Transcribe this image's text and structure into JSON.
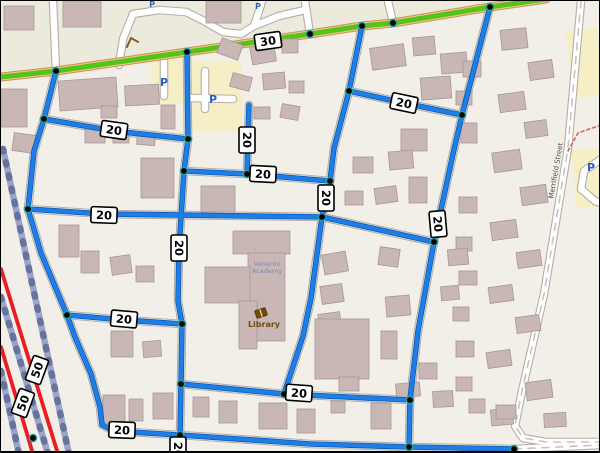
{
  "map": {
    "title": "speed-limit-map-view",
    "colors": {
      "background": "#f2efe9",
      "commercial_band": "#eceadc",
      "parking_fill": "#f6efc5",
      "building_fill": "#c9b7b6",
      "building_stroke": "#a99595",
      "road_white": "#ffffff",
      "road_casing": "#b3afa6",
      "route_20_blue_dark": "#0d5ab2",
      "route_20_blue": "#1f7de6",
      "road_30_green": "#55c418",
      "road_30_casing": "#c99254",
      "road_30_fill": "#f2c78e",
      "road_50_red": "#ea1c24",
      "railway": "#9aa5c8",
      "railway_ties": "#66739f",
      "node_fill": "#000000",
      "node_ring": "#1fa3a3",
      "badge_bg": "#ffffff",
      "badge_border": "#000000",
      "parking_letter": "#2e5fc4",
      "library_brown": "#744a0b",
      "academy_label": "#7a88ad",
      "street_label": "#4f4f4f"
    },
    "speed_limit_legend": {
      "blue_roads": "20",
      "green_road": "30",
      "red_roads": "50"
    },
    "landuse": {
      "commercial_band": [
        [
          0,
          0
        ],
        [
          545,
          0
        ],
        [
          489,
          6
        ],
        [
          361,
          25
        ],
        [
          186,
          51
        ],
        [
          55,
          70
        ],
        [
          0,
          76
        ]
      ],
      "parking_lots": [
        [
          150,
          56,
          38,
          46,
          0
        ],
        [
          187,
          60,
          54,
          70,
          0
        ],
        [
          573,
          148,
          30,
          58,
          -5
        ],
        [
          568,
          28,
          32,
          68,
          -6
        ]
      ]
    },
    "major_road_30": [
      [
        0,
        76
      ],
      [
        55,
        70
      ],
      [
        186,
        51
      ],
      [
        309,
        33
      ],
      [
        361,
        25
      ],
      [
        392,
        22
      ],
      [
        489,
        6
      ],
      [
        545,
        -2
      ]
    ],
    "railways": [
      [
        [
          2,
          148
        ],
        [
          68,
          453
        ]
      ],
      [
        [
          0,
          296
        ],
        [
          47,
          453
        ]
      ],
      [
        [
          0,
          370
        ],
        [
          18,
          453
        ]
      ]
    ],
    "trunk_roads_50": [
      [
        [
          0,
          268
        ],
        [
          57,
          453
        ]
      ],
      [
        [
          0,
          346
        ],
        [
          32,
          453
        ]
      ]
    ],
    "routes_20": [
      [
        [
          55,
          70
        ],
        [
          43,
          118
        ],
        [
          33,
          150
        ],
        [
          27,
          208
        ],
        [
          40,
          252
        ],
        [
          66,
          314
        ],
        [
          74,
          336
        ],
        [
          90,
          373
        ],
        [
          99,
          406
        ],
        [
          101,
          424
        ],
        [
          113,
          430
        ],
        [
          179,
          434
        ],
        [
          310,
          443
        ],
        [
          408,
          446
        ],
        [
          513,
          448
        ]
      ],
      [
        [
          43,
          118
        ],
        [
          113,
          130
        ],
        [
          187,
          138
        ]
      ],
      [
        [
          186,
          51
        ],
        [
          187,
          138
        ],
        [
          183,
          170
        ],
        [
          178,
          248
        ],
        [
          177,
          300
        ],
        [
          181,
          323
        ],
        [
          180,
          383
        ],
        [
          179,
          434
        ],
        [
          177,
          453
        ]
      ],
      [
        [
          27,
          208
        ],
        [
          103,
          213
        ],
        [
          321,
          216
        ]
      ],
      [
        [
          183,
          170
        ],
        [
          246,
          173
        ],
        [
          329,
          180
        ]
      ],
      [
        [
          248,
          104
        ],
        [
          246,
          173
        ]
      ],
      [
        [
          361,
          25
        ],
        [
          348,
          90
        ],
        [
          333,
          147
        ],
        [
          329,
          180
        ],
        [
          321,
          216
        ],
        [
          310,
          297
        ],
        [
          302,
          335
        ],
        [
          283,
          393
        ]
      ],
      [
        [
          348,
          90
        ],
        [
          403,
          102
        ],
        [
          461,
          114
        ]
      ],
      [
        [
          489,
          6
        ],
        [
          461,
          114
        ],
        [
          452,
          153
        ],
        [
          433,
          241
        ],
        [
          417,
          330
        ],
        [
          409,
          399
        ],
        [
          408,
          446
        ]
      ],
      [
        [
          321,
          216
        ],
        [
          433,
          241
        ]
      ],
      [
        [
          66,
          314
        ],
        [
          123,
          319
        ],
        [
          181,
          323
        ]
      ],
      [
        [
          180,
          383
        ],
        [
          283,
          393
        ],
        [
          409,
          399
        ]
      ]
    ],
    "nodes": [
      [
        55,
        70
      ],
      [
        186,
        51
      ],
      [
        309,
        33
      ],
      [
        361,
        25
      ],
      [
        392,
        22
      ],
      [
        489,
        6
      ],
      [
        43,
        118
      ],
      [
        187,
        138
      ],
      [
        348,
        90
      ],
      [
        461,
        114
      ],
      [
        183,
        170
      ],
      [
        246,
        173
      ],
      [
        27,
        208
      ],
      [
        329,
        180
      ],
      [
        321,
        216
      ],
      [
        433,
        241
      ],
      [
        66,
        314
      ],
      [
        181,
        323
      ],
      [
        180,
        383
      ],
      [
        283,
        393
      ],
      [
        409,
        399
      ],
      [
        179,
        434
      ],
      [
        408,
        446
      ],
      [
        513,
        448
      ],
      [
        32,
        437
      ]
    ],
    "badges": [
      {
        "label": "30",
        "x": 267,
        "y": 40,
        "rot": -8
      },
      {
        "label": "20",
        "x": 113,
        "y": 129,
        "rot": 8
      },
      {
        "label": "20",
        "x": 246,
        "y": 139,
        "rot": 90
      },
      {
        "label": "20",
        "x": 403,
        "y": 102,
        "rot": 12
      },
      {
        "label": "20",
        "x": 262,
        "y": 173,
        "rot": 3
      },
      {
        "label": "20",
        "x": 103,
        "y": 214,
        "rot": 2
      },
      {
        "label": "20",
        "x": 325,
        "y": 197,
        "rot": 90
      },
      {
        "label": "20",
        "x": 437,
        "y": 223,
        "rot": 85
      },
      {
        "label": "20",
        "x": 178,
        "y": 247,
        "rot": 90
      },
      {
        "label": "20",
        "x": 123,
        "y": 318,
        "rot": 5
      },
      {
        "label": "20",
        "x": 298,
        "y": 392,
        "rot": 4
      },
      {
        "label": "20",
        "x": 121,
        "y": 429,
        "rot": 2
      },
      {
        "label": "20",
        "x": 177,
        "y": 449,
        "rot": 90
      },
      {
        "label": "50",
        "x": 36,
        "y": 369,
        "rot": -70
      },
      {
        "label": "50",
        "x": 22,
        "y": 402,
        "rot": -70
      }
    ],
    "white_roads": [
      [
        [
          52,
          0
        ],
        [
          55,
          70
        ]
      ],
      [
        [
          118,
          64
        ],
        [
          122,
          38
        ],
        [
          132,
          13
        ],
        [
          158,
          9
        ],
        [
          185,
          11
        ],
        [
          203,
          20
        ],
        [
          222,
          31
        ],
        [
          240,
          33
        ],
        [
          253,
          25
        ],
        [
          258,
          10
        ],
        [
          261,
          0
        ]
      ],
      [
        [
          253,
          25
        ],
        [
          278,
          15
        ],
        [
          304,
          9
        ]
      ],
      [
        [
          304,
          0
        ],
        [
          309,
          33
        ]
      ],
      [
        [
          387,
          0
        ],
        [
          392,
          22
        ]
      ],
      [
        [
          204,
          70
        ],
        [
          204,
          108
        ]
      ],
      [
        [
          190,
          97
        ],
        [
          232,
          98
        ]
      ],
      [
        [
          163,
          60
        ],
        [
          163,
          95
        ]
      ],
      [
        [
          600,
          158
        ],
        [
          583,
          170
        ],
        [
          580,
          188
        ],
        [
          594,
          200
        ],
        [
          600,
          202
        ]
      ]
    ],
    "merrifield_road": [
      [
        580,
        0
      ],
      [
        567,
        147
      ],
      [
        543,
        293
      ],
      [
        521,
        390
      ],
      [
        514,
        425
      ],
      [
        522,
        437
      ],
      [
        545,
        441
      ],
      [
        600,
        441
      ]
    ],
    "bottom_east_road": [
      [
        513,
        448
      ],
      [
        600,
        444
      ]
    ],
    "red_dashed_path": [
      [
        600,
        124
      ],
      [
        577,
        132
      ],
      [
        567,
        150
      ]
    ],
    "brown_arc": [
      [
        126,
        46
      ],
      [
        130,
        37
      ],
      [
        137,
        41
      ]
    ],
    "buildings": [
      [
        3,
        5,
        30,
        24,
        0
      ],
      [
        62,
        0,
        38,
        26,
        0
      ],
      [
        205,
        0,
        35,
        22,
        0
      ],
      [
        0,
        88,
        26,
        38,
        0
      ],
      [
        58,
        78,
        58,
        30,
        -4
      ],
      [
        124,
        84,
        34,
        20,
        -3
      ],
      [
        12,
        133,
        22,
        18,
        8
      ],
      [
        84,
        128,
        20,
        14,
        0
      ],
      [
        112,
        130,
        16,
        12,
        0
      ],
      [
        136,
        132,
        18,
        12,
        4
      ],
      [
        100,
        105,
        16,
        12,
        0
      ],
      [
        160,
        104,
        14,
        24,
        0
      ],
      [
        140,
        157,
        33,
        40,
        0
      ],
      [
        200,
        185,
        34,
        26,
        0
      ],
      [
        218,
        40,
        22,
        16,
        20
      ],
      [
        250,
        44,
        24,
        18,
        -10
      ],
      [
        281,
        38,
        16,
        14,
        0
      ],
      [
        230,
        74,
        20,
        14,
        15
      ],
      [
        262,
        72,
        22,
        16,
        -5
      ],
      [
        288,
        80,
        15,
        12,
        0
      ],
      [
        253,
        106,
        16,
        12,
        0
      ],
      [
        280,
        104,
        18,
        14,
        10
      ],
      [
        370,
        45,
        34,
        22,
        -8
      ],
      [
        412,
        36,
        22,
        18,
        -5
      ],
      [
        440,
        52,
        26,
        20,
        -5
      ],
      [
        420,
        76,
        30,
        22,
        -4
      ],
      [
        400,
        128,
        26,
        22,
        0
      ],
      [
        352,
        156,
        20,
        16,
        0
      ],
      [
        388,
        150,
        24,
        18,
        -5
      ],
      [
        344,
        190,
        18,
        14,
        0
      ],
      [
        374,
        186,
        22,
        16,
        -8
      ],
      [
        408,
        176,
        18,
        26,
        0
      ],
      [
        500,
        28,
        26,
        20,
        -6
      ],
      [
        528,
        60,
        24,
        18,
        -8
      ],
      [
        462,
        60,
        18,
        16,
        0
      ],
      [
        455,
        90,
        16,
        14,
        0
      ],
      [
        498,
        92,
        26,
        18,
        -8
      ],
      [
        524,
        120,
        22,
        16,
        -8
      ],
      [
        460,
        122,
        16,
        20,
        0
      ],
      [
        492,
        150,
        28,
        20,
        -8
      ],
      [
        520,
        185,
        26,
        18,
        -8
      ],
      [
        458,
        196,
        18,
        16,
        0
      ],
      [
        490,
        220,
        26,
        18,
        -8
      ],
      [
        455,
        236,
        16,
        14,
        0
      ],
      [
        516,
        250,
        24,
        16,
        -8
      ],
      [
        458,
        270,
        18,
        14,
        0
      ],
      [
        488,
        285,
        24,
        16,
        -8
      ],
      [
        452,
        306,
        16,
        14,
        0
      ],
      [
        515,
        315,
        24,
        16,
        -8
      ],
      [
        455,
        340,
        18,
        16,
        0
      ],
      [
        486,
        350,
        24,
        16,
        -8
      ],
      [
        525,
        380,
        26,
        18,
        -8
      ],
      [
        455,
        376,
        16,
        14,
        0
      ],
      [
        490,
        408,
        22,
        16,
        -5
      ],
      [
        543,
        412,
        22,
        14,
        -3
      ],
      [
        58,
        224,
        20,
        32,
        0
      ],
      [
        80,
        250,
        18,
        22,
        0
      ],
      [
        110,
        255,
        20,
        18,
        -8
      ],
      [
        135,
        265,
        18,
        16,
        0
      ],
      [
        110,
        330,
        22,
        26,
        0
      ],
      [
        142,
        340,
        18,
        16,
        -5
      ],
      [
        102,
        394,
        22,
        28,
        0
      ],
      [
        128,
        398,
        14,
        22,
        0
      ],
      [
        152,
        392,
        20,
        26,
        0
      ],
      [
        322,
        252,
        24,
        20,
        -10
      ],
      [
        320,
        284,
        22,
        18,
        -8
      ],
      [
        318,
        312,
        22,
        20,
        -8
      ],
      [
        378,
        247,
        20,
        18,
        8
      ],
      [
        385,
        295,
        24,
        20,
        -5
      ],
      [
        380,
        330,
        16,
        28,
        0
      ],
      [
        418,
        362,
        18,
        16,
        0
      ],
      [
        447,
        248,
        20,
        16,
        -5
      ],
      [
        440,
        285,
        18,
        14,
        -5
      ],
      [
        258,
        402,
        28,
        26,
        0
      ],
      [
        296,
        408,
        18,
        24,
        0
      ],
      [
        330,
        400,
        14,
        12,
        0
      ],
      [
        218,
        400,
        18,
        22,
        0
      ],
      [
        192,
        396,
        16,
        20,
        0
      ],
      [
        370,
        402,
        20,
        26,
        0
      ],
      [
        395,
        382,
        24,
        14,
        -5
      ],
      [
        432,
        390,
        20,
        16,
        -3
      ],
      [
        468,
        398,
        16,
        14,
        0
      ],
      [
        495,
        404,
        20,
        14,
        0
      ],
      [
        232,
        230,
        57,
        23,
        0
      ],
      [
        247,
        252,
        37,
        88,
        0
      ],
      [
        204,
        266,
        45,
        36,
        0
      ],
      [
        238,
        300,
        18,
        48,
        0
      ],
      [
        314,
        318,
        54,
        60,
        0
      ],
      [
        338,
        376,
        20,
        14,
        0
      ]
    ],
    "labels": {
      "academy": {
        "lines": [
          "Venerini",
          "Academy"
        ],
        "x": 266,
        "y": 265,
        "size": 6.5
      },
      "library": {
        "text": "Library",
        "x": 263,
        "y": 326,
        "size": 8
      },
      "merrifield": {
        "text": "Merrifield Street",
        "x": 557,
        "y": 170,
        "size": 7,
        "rot": -80
      }
    },
    "parking_icons": [
      {
        "label": "P",
        "x": 163,
        "y": 85,
        "size": 11
      },
      {
        "label": "P",
        "x": 212,
        "y": 102,
        "size": 11
      },
      {
        "label": "P",
        "x": 590,
        "y": 170,
        "size": 11
      },
      {
        "label": "P",
        "x": 151,
        "y": 6,
        "size": 8
      },
      {
        "label": "P",
        "x": 257,
        "y": 8,
        "size": 8
      }
    ]
  }
}
